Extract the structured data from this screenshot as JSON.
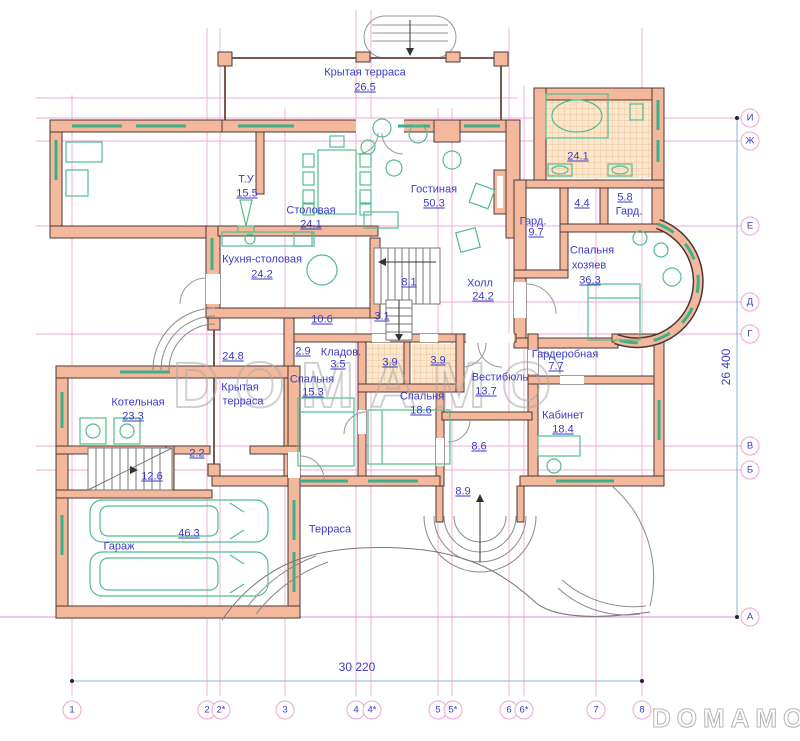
{
  "watermark": "DOMAMO",
  "dimensions": {
    "horizontal": "30 220",
    "vertical": "26 400"
  },
  "axes": {
    "bottom": [
      "1",
      "2",
      "2*",
      "3",
      "4",
      "4*",
      "5",
      "5*",
      "6",
      "6*",
      "7",
      "8"
    ],
    "right": [
      "И",
      "Ж",
      "Е",
      "Д",
      "Г",
      "В",
      "Б",
      "А"
    ]
  },
  "rooms": {
    "terrace_top": {
      "name": "Крытая терраса",
      "area": "26.5"
    },
    "tu": {
      "name": "Т.У",
      "area": "15.5"
    },
    "dining": {
      "name": "Столовая",
      "area": "24.1"
    },
    "living": {
      "name": "Гостиная",
      "area": "50.3"
    },
    "bath_master": {
      "area": "24.1"
    },
    "wc_44": {
      "area": "4.4"
    },
    "ward_58": {
      "name": "Гард.",
      "area": "5.8"
    },
    "ward_97": {
      "name": "Гард.",
      "area": "9.7"
    },
    "master": {
      "name_line1": "Спальня",
      "name_line2": "хозяев",
      "area": "36.3"
    },
    "kitchen": {
      "name": "Кухня-столовая",
      "area": "24.2"
    },
    "hall": {
      "name": "Холл",
      "area": "24.2"
    },
    "stair_81": {
      "area": "8.1"
    },
    "corr_106": {
      "area": "10.6"
    },
    "stair_31": {
      "area": "3.1"
    },
    "terrace_left": {
      "name_line1": "Крытая",
      "name_line2": "терраса",
      "area": "24.8"
    },
    "c_29": {
      "area": "2.9"
    },
    "storage": {
      "name": "Кладов.",
      "area": "3.5"
    },
    "bed1": {
      "name": "Спальня",
      "area": "15.3"
    },
    "bath_a": {
      "area": "3.9"
    },
    "bath_b": {
      "area": "3.9"
    },
    "vestibule": {
      "name": "Вестибюль",
      "area": "13.7"
    },
    "wardrobe": {
      "name": "Гардеробная",
      "area": "7.7"
    },
    "boiler": {
      "name": "Котельная",
      "area": "23.3"
    },
    "bed2": {
      "name": "Спальня",
      "area": "18.6"
    },
    "office": {
      "name": "Кабинет",
      "area": "18.4"
    },
    "c_22": {
      "area": "2.2"
    },
    "corr_86": {
      "area": "8.6"
    },
    "stair_126": {
      "area": "12.6"
    },
    "porch_89": {
      "area": "8.9"
    },
    "garage": {
      "name": "Гараж",
      "area": "46.3"
    },
    "terrace_south": {
      "name": "Терраса"
    }
  }
}
